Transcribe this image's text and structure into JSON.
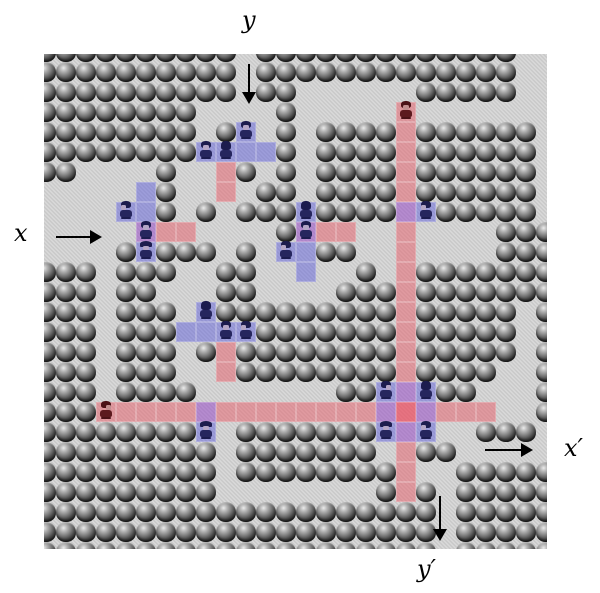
{
  "figure": {
    "description": "Pokemon-style boulder maze map with trainer line-of-sight highlights and crossing gadget annotations",
    "labels": {
      "x": "x",
      "y": "y",
      "x_prime": "x′",
      "y_prime": "y′"
    }
  },
  "grid": {
    "cols": 26,
    "rows": 26,
    "tile": 20,
    "origin_x": 36,
    "origin_y": 42,
    "viewport": {
      "left": 44,
      "top": 54,
      "width": 503,
      "height": 495
    },
    "legend": {
      "B": "boulder",
      ".": "path"
    },
    "map_rows": [
      "BBBBBBBBBB.BBBBBBBBBBBBB..",
      "BBBBBBBBBB.BBBBBBBBBBBBB..",
      "BBBBBBBBBB.BB......BBBBB..",
      "BBBBBBBB....B.............",
      "BBBBBBBB.B..B.BBBB.BBBBBB.",
      "BBBBBBBB....B.BBBB.BBBBBB.",
      "BB....B...B.B.BBBB.BBBBBB.",
      "......B....BB.BBBB.BBBBBB.",
      "......B.B.BBB.BBBB..BBBBB.",
      "............B..........BBB",
      "....B.BBB.B...BB.......BBB",
      "BBB.BBB..BB.....B..BBBBBBB",
      "BBB.BB...BB....BBB.BBBBBBB",
      "BBB.BBB..BBBBBBBBB.BBBBB.B",
      "BBB.BBB....BBBBBBB.BBBBB.B",
      "BBB.BBB.B.BBBBBBBB.BBBBB.B",
      "BBB.BBB...BBBBBBBB.BBBB..B",
      "BBB.BBBB.......BB...BB...B",
      "BBB......................B",
      "BBBBBBBB..BBBBBBB.....BBB.",
      "BBBBBBBBB.BBBBBBB..BB.....",
      "BBBBBBBBB.BBBBBBBB...BBBBB",
      "BBBBBBBBB........B.B.BBBBB",
      "BBBBBBBBBBBBBBBBBBBB.BBBBB",
      "BBBBBBBBBBBBBBBBBBBB.BBBBB",
      "BBBBBBBBBBBBBBBBBBBB.BBBBB"
    ]
  },
  "overlays": {
    "red_tiles": [
      [
        18,
        3
      ],
      [
        18,
        4
      ],
      [
        18,
        5
      ],
      [
        18,
        6
      ],
      [
        18,
        7
      ],
      [
        18,
        9
      ],
      [
        18,
        10
      ],
      [
        18,
        11
      ],
      [
        18,
        12
      ],
      [
        18,
        13
      ],
      [
        18,
        14
      ],
      [
        18,
        15
      ],
      [
        18,
        16
      ],
      [
        18,
        20
      ],
      [
        18,
        21
      ],
      [
        18,
        22
      ],
      [
        3,
        18
      ],
      [
        4,
        18
      ],
      [
        5,
        18
      ],
      [
        6,
        18
      ],
      [
        7,
        18
      ],
      [
        9,
        18
      ],
      [
        10,
        18
      ],
      [
        11,
        18
      ],
      [
        12,
        18
      ],
      [
        13,
        18
      ],
      [
        14,
        18
      ],
      [
        15,
        18
      ],
      [
        16,
        18
      ],
      [
        20,
        18
      ],
      [
        21,
        18
      ],
      [
        22,
        18
      ],
      [
        9,
        6
      ],
      [
        9,
        7
      ],
      [
        6,
        9
      ],
      [
        7,
        9
      ],
      [
        14,
        9
      ],
      [
        15,
        9
      ],
      [
        9,
        15
      ],
      [
        9,
        16
      ]
    ],
    "blue_tiles": [
      [
        10,
        4
      ],
      [
        8,
        5
      ],
      [
        9,
        5
      ],
      [
        10,
        5
      ],
      [
        11,
        5
      ],
      [
        5,
        7
      ],
      [
        4,
        8
      ],
      [
        5,
        8
      ],
      [
        5,
        10
      ],
      [
        13,
        8
      ],
      [
        12,
        10
      ],
      [
        13,
        10
      ],
      [
        13,
        11
      ],
      [
        8,
        13
      ],
      [
        7,
        14
      ],
      [
        8,
        14
      ],
      [
        9,
        14
      ],
      [
        10,
        14
      ],
      [
        19,
        8
      ],
      [
        8,
        19
      ],
      [
        17,
        17
      ],
      [
        19,
        17
      ],
      [
        17,
        19
      ],
      [
        19,
        19
      ]
    ],
    "purple_tiles": [
      [
        5,
        9
      ],
      [
        13,
        9
      ],
      [
        18,
        8
      ],
      [
        8,
        18
      ],
      [
        17,
        18
      ],
      [
        19,
        18
      ],
      [
        18,
        17
      ],
      [
        18,
        19
      ]
    ],
    "center_tiles": [
      [
        18,
        18
      ]
    ]
  },
  "trainers": [
    {
      "c": 18,
      "r": 3,
      "facing": "down",
      "tint": "red"
    },
    {
      "c": 10,
      "r": 4,
      "facing": "down",
      "tint": "blue"
    },
    {
      "c": 8,
      "r": 5,
      "facing": "down",
      "tint": "blue"
    },
    {
      "c": 9,
      "r": 5,
      "facing": "up",
      "tint": "blue"
    },
    {
      "c": 4,
      "r": 8,
      "facing": "left",
      "tint": "blue"
    },
    {
      "c": 5,
      "r": 9,
      "facing": "down",
      "tint": "blue"
    },
    {
      "c": 5,
      "r": 10,
      "facing": "helmet",
      "tint": "blue"
    },
    {
      "c": 13,
      "r": 8,
      "facing": "up",
      "tint": "blue"
    },
    {
      "c": 13,
      "r": 9,
      "facing": "down",
      "tint": "blue"
    },
    {
      "c": 12,
      "r": 10,
      "facing": "left",
      "tint": "blue"
    },
    {
      "c": 19,
      "r": 8,
      "facing": "left",
      "tint": "blue"
    },
    {
      "c": 8,
      "r": 13,
      "facing": "up",
      "tint": "blue"
    },
    {
      "c": 9,
      "r": 14,
      "facing": "down",
      "tint": "blue"
    },
    {
      "c": 10,
      "r": 14,
      "facing": "left",
      "tint": "blue"
    },
    {
      "c": 3,
      "r": 18,
      "facing": "right",
      "tint": "red"
    },
    {
      "c": 8,
      "r": 19,
      "facing": "helmet",
      "tint": "blue"
    },
    {
      "c": 17,
      "r": 17,
      "facing": "right",
      "tint": "blue"
    },
    {
      "c": 19,
      "r": 17,
      "facing": "up",
      "tint": "blue"
    },
    {
      "c": 17,
      "r": 19,
      "facing": "helmet",
      "tint": "blue"
    },
    {
      "c": 19,
      "r": 19,
      "facing": "left",
      "tint": "blue"
    }
  ],
  "annotations": {
    "arrows": [
      {
        "name": "y-arrow",
        "dir": "down",
        "x": 249,
        "y1": 64,
        "y2": 104
      },
      {
        "name": "x-arrow",
        "dir": "right",
        "y": 237,
        "x1": 56,
        "x2": 102
      },
      {
        "name": "x-prime-arrow",
        "dir": "right",
        "y": 450,
        "x1": 485,
        "x2": 533
      },
      {
        "name": "y-prime-arrow",
        "dir": "down",
        "x": 440,
        "y1": 496,
        "y2": 541
      }
    ],
    "label_positions": {
      "y": {
        "left": 242,
        "top": 8
      },
      "x": {
        "left": 14,
        "top": 221
      },
      "x_prime": {
        "left": 564,
        "top": 436
      },
      "y_prime": {
        "left": 417,
        "top": 557
      }
    }
  },
  "colors": {
    "path_base": "#c9c9c9",
    "red_overlay": "rgba(231,85,98,0.48)",
    "blue_overlay": "rgba(80,80,218,0.44)",
    "purple_overlay": "rgba(146,62,198,0.50)",
    "center_overlay": "rgba(238,62,84,0.66)",
    "sprite_blue_hair": "#1c1c4e",
    "sprite_blue_body": "#26265e",
    "sprite_blue_face": "#b4a6c6",
    "sprite_red_hair": "#4a1216",
    "sprite_red_body": "#5c1a1e",
    "sprite_red_face": "#c08e8e"
  }
}
